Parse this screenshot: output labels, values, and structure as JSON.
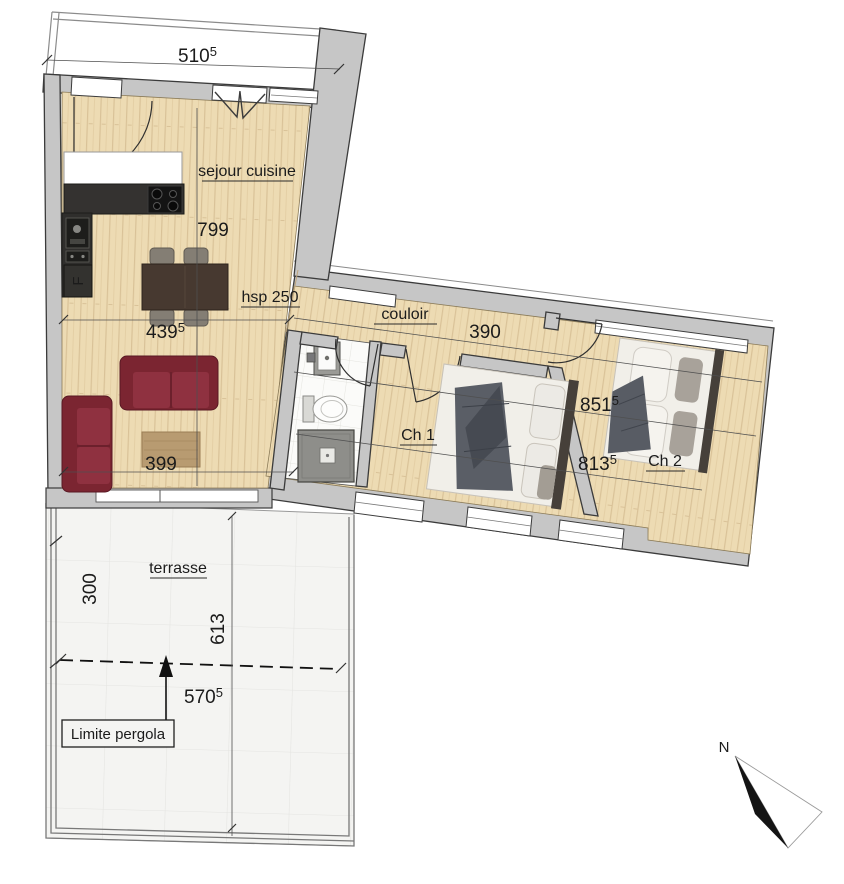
{
  "plan": {
    "rooms": {
      "sejour": {
        "label": "sejour cuisine"
      },
      "couloir": {
        "label": "couloir"
      },
      "ch1": {
        "label": "Ch 1"
      },
      "ch2": {
        "label": "Ch 2"
      },
      "terrasse": {
        "label": "terrasse"
      }
    },
    "dims": {
      "d510": {
        "text": "510",
        "sup": "5"
      },
      "d799": {
        "text": "799"
      },
      "hsp": {
        "text": "hsp 250"
      },
      "d439": {
        "text": "439",
        "sup": "5"
      },
      "d399": {
        "text": "399"
      },
      "d390": {
        "text": "390"
      },
      "d851": {
        "text": "851",
        "sup": "5"
      },
      "d813": {
        "text": "813",
        "sup": "5"
      },
      "d300": {
        "text": "300"
      },
      "d613": {
        "text": "613"
      },
      "d570": {
        "text": "570",
        "sup": "5"
      }
    },
    "annotations": {
      "limite_pergola": "Limite pergola",
      "north": "N",
      "fridge": "F"
    },
    "colors": {
      "wood": "#eddbb3",
      "wall": "#c6c6c6",
      "sofa": "#8a2c39",
      "terrace": "#f4f4f2",
      "throw": "#5a5e66"
    }
  }
}
